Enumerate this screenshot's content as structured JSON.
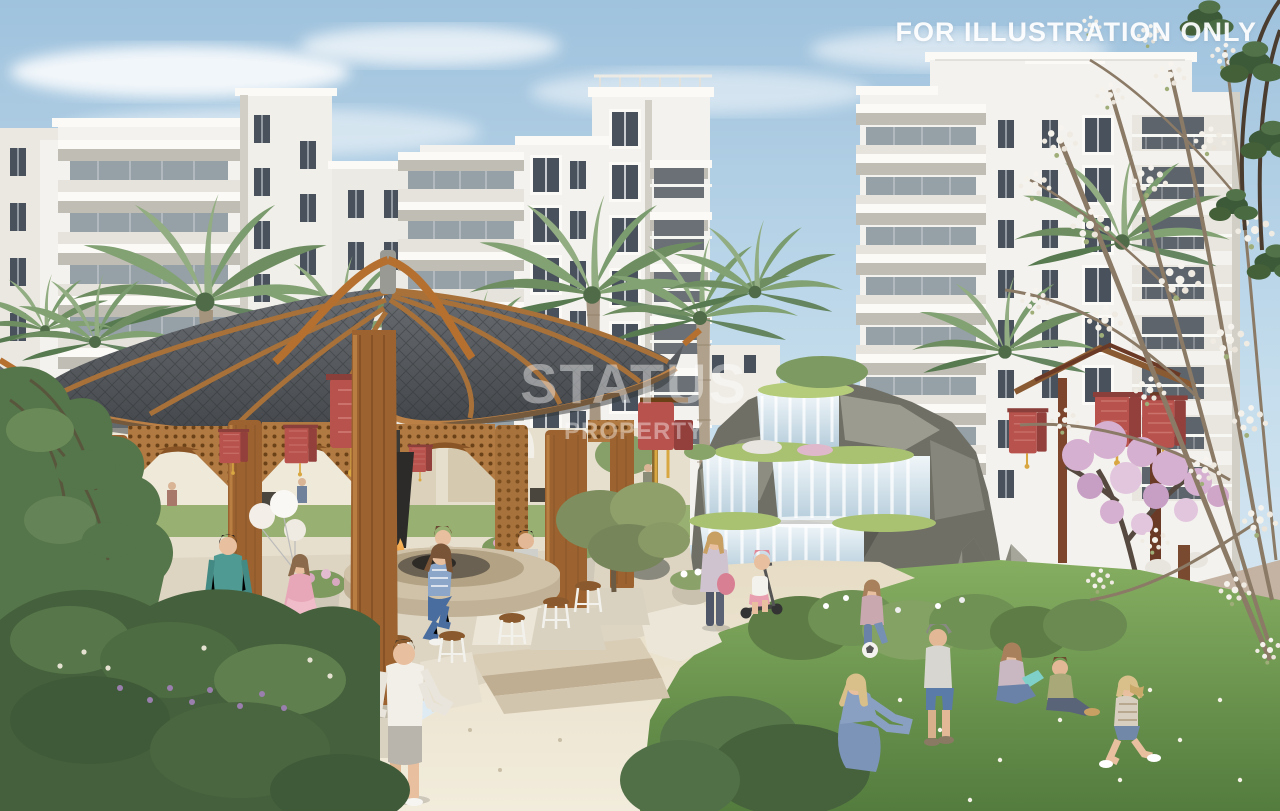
{
  "overlay": {
    "disclaimer": "FOR ILLUSTRATION ONLY",
    "watermark_line1": "STATUS",
    "watermark_line2": "PROPERTY"
  },
  "palette": {
    "sky_top": "#9fc2dd",
    "sky_horizon": "#d9e8f1",
    "building_white": "#f4f2ee",
    "roof_tile": "#565a5e",
    "wood": "#9c6330",
    "lantern_red": "#b7524d",
    "fire_orange": "#f09a3e",
    "grass_green": "#74a055",
    "path_beige": "#eae2cd",
    "water_blue": "#dce9f0",
    "blossom_pink": "#d5b0cf",
    "rock_gray": "#82817a"
  }
}
